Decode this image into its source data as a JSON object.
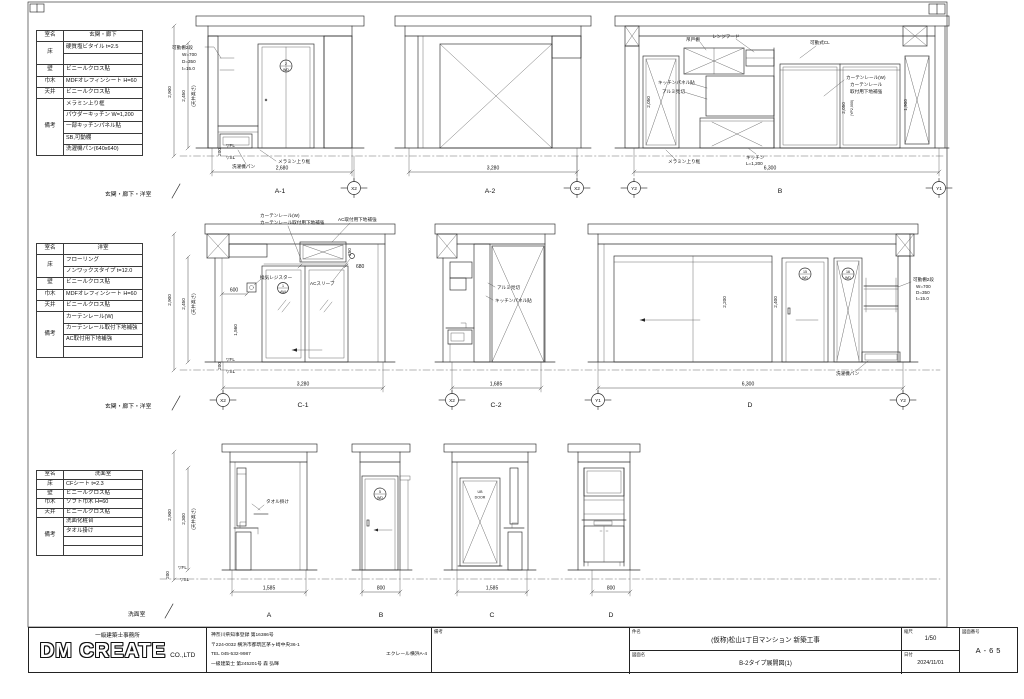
{
  "common": {
    "fl": "▽FL",
    "sl": "▽SL"
  },
  "specs": {
    "s1": {
      "room_label": "室名",
      "room": "玄関・廊下",
      "floor_label": "床",
      "floor1": "硬質塩ビタイル t=2.5",
      "floor2": "",
      "wall_label": "壁",
      "wall": "ビニールクロス貼",
      "base_label": "巾木",
      "base": "MDFオレフィンシート H=60",
      "ceiling_label": "天井",
      "ceiling": "ビニールクロス貼",
      "note_label": "備考",
      "note1": "メラミン上り框",
      "note2": "パウダーキッチン W=1,200",
      "note3": "一部キッチンパネル貼",
      "note4": "SB,可動棚",
      "note5": "洗濯機パン(640x640)"
    },
    "s2": {
      "room_label": "室名",
      "room": "洋室",
      "floor_label": "床",
      "floor1": "フローリング",
      "floor2": "ノンワックスタイプ t=12.0",
      "wall_label": "壁",
      "wall": "ビニールクロス貼",
      "base_label": "巾木",
      "base": "MDFオレフィンシート H=60",
      "ceiling_label": "天井",
      "ceiling": "ビニールクロス貼",
      "note_label": "備考",
      "note1": "カーテンレール(W)",
      "note2": "カーテンレール取付下地補強",
      "note3": "AC取付用下地補強",
      "note4": ""
    },
    "s3": {
      "room_label": "室名",
      "room": "洗面室",
      "floor_label": "床",
      "floor1": "CFシート t=2.3",
      "wall_label": "壁",
      "wall": "ビニールクロス貼",
      "base_label": "巾木",
      "base": "ソフト巾木 H=60",
      "ceiling_label": "天井",
      "ceiling": "ビニールクロス貼",
      "note_label": "備考",
      "note1": "洗面化粧台",
      "note2": "タオル掛け",
      "note3": "",
      "note4": ""
    }
  },
  "row1": {
    "section": "玄関・廊下・洋室",
    "dim_total": "2,900",
    "dim_ceiling": "2,450",
    "dim_ceiling_note": "(天井高さ)",
    "dim_base": "200",
    "shelf1": "可動棚2段",
    "shelf2": "W=700",
    "shelf3": "D=350",
    "shelf4": "t=15.0",
    "a1_label": "A-1",
    "a1_dim": "2,680",
    "a1_grid": "X2",
    "a1_pan": "洗濯機パン",
    "a1_kamachi": "メラミン上り框",
    "a1_door_no": "2",
    "a1_door_type": "WD",
    "a2_label": "A-2",
    "a2_dim": "3,280",
    "a2_grid": "X2",
    "b_label": "B",
    "b_dim": "6,300",
    "b_grid_l": "Y2",
    "b_grid_r": "Y1",
    "b_tsuridana": "吊戸棚",
    "b_rangehood": "レンジフード",
    "b_panel": "キッチンパネル貼",
    "b_mikiri": "アルミ見切",
    "b_kamachi": "メラミン上り框",
    "b_kitchen": "キッチン",
    "b_kitchen_l": "L=1,200",
    "b_cl": "可動式CL",
    "b_curtain1": "カーテンレール(W)",
    "b_curtain2": "カーテンレール",
    "b_curtain3": "取付用下地補強",
    "b_door_dim": "2,050",
    "b_win_dim1": "2,050",
    "b_win_dim2": "(YP2,000)",
    "b_win_dim3": "1,900"
  },
  "row2": {
    "section": "玄関・廊下・洋室",
    "dim_total": "2,900",
    "dim_ceiling": "2,450",
    "dim_ceiling_note": "(天井高さ)",
    "dim_base": "200",
    "c1_label": "C-1",
    "c1_dim": "3,280",
    "c1_grid": "X2",
    "c1_curtain1": "カーテンレール(W)",
    "c1_curtain2": "カーテンレール取付用下地補強",
    "c1_ac": "AC取付用下地補強",
    "c1_register": "換気レジスター",
    "c1_sleeve": "ACスリーブ",
    "c1_dim600": "600",
    "c1_dim680": "680",
    "c1_dim250": "250",
    "c1_dimh": "1,560",
    "c1_win_no": "1",
    "c1_win_type": "AW",
    "c2_label": "C-2",
    "c2_dim": "1,685",
    "c2_grid": "X2",
    "c2_mikiri": "アルミ見切",
    "c2_panel": "キッチンパネル貼",
    "d_label": "D",
    "d_dim": "6,300",
    "d_grid_l": "Y1",
    "d_grid_r": "Y2",
    "d_dim1": "2,200",
    "d_dim2": "2,400",
    "d_door1_no": "15",
    "d_door1_type": "WD",
    "d_door2_no": "16",
    "d_door2_type": "WD",
    "d_shelf1": "可動棚2段",
    "d_shelf2": "W=700",
    "d_shelf3": "D=350",
    "d_shelf4": "t=15.0",
    "d_pan": "洗濯機パン"
  },
  "row3": {
    "section": "洗面室",
    "dim_total": "2,900",
    "dim_ceiling": "2,300",
    "dim_ceiling_note": "(天井高さ)",
    "dim_base": "200",
    "a_label": "A",
    "a_dim": "1,585",
    "a_towel": "タオル掛け",
    "b_label": "B",
    "b_dim": "800",
    "b_door_no": "5",
    "b_door_type": "WD",
    "c_label": "C",
    "c_dim": "1,585",
    "c_door1": "UB",
    "c_door2": "DOOR",
    "d_label": "D",
    "d_dim": "800"
  },
  "titleblock": {
    "office": "一級建築士事務所",
    "company": "DM CREATE",
    "company_suffix": "CO.,LTD",
    "registration": "神奈川県知事登録 第16386号",
    "address": "〒224-0032 横浜市都筑区茅ヶ崎中央36-1",
    "building": "エクレール横浜A-4",
    "tel": "TEL 045-532-9987",
    "architect": "一級建築士 第245201号 森 弘暉",
    "remarks_label": "備考",
    "project_label": "件名",
    "project": "(仮称)松山1丁目マンション 新築工事",
    "drawing_label": "図面名",
    "drawing": "B-2タイプ展開図(1)",
    "scale_label": "縮尺",
    "scale": "1/50",
    "date_label": "日付",
    "date": "2024/11/01",
    "number_label": "図面番号",
    "number": "A-65"
  }
}
